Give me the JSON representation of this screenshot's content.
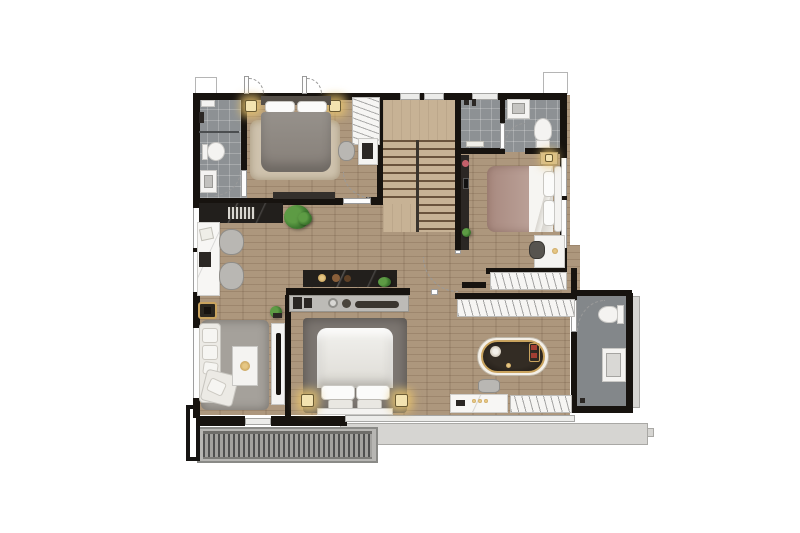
{
  "scene": {
    "type": "architectural-floor-plan",
    "view": "top-down-render",
    "floor": "upper-floor-with-staircase",
    "rooms": [
      {
        "id": "bathroom-top-left",
        "features": [
          "shower",
          "toilet",
          "washbasin"
        ]
      },
      {
        "id": "bedroom-top-left",
        "features": [
          "double-bed",
          "area-rug",
          "bedside-lamps",
          "wardrobe",
          "desk",
          "office-chair",
          "balcony-doors",
          "bench-runner"
        ]
      },
      {
        "id": "staircase",
        "features": [
          "u-shaped-stairs",
          "upper-landing",
          "railing"
        ]
      },
      {
        "id": "bathroom-top-right",
        "features": [
          "shower-fittings",
          "washbasin",
          "toilet",
          "door-swing"
        ]
      },
      {
        "id": "bedroom-right",
        "features": [
          "double-bed",
          "tv-console",
          "nightstand-lamp",
          "desk",
          "chair",
          "windows"
        ]
      },
      {
        "id": "walk-in-closet",
        "features": [
          "upper-wardrobe-run",
          "lower-wardrobe-run"
        ]
      },
      {
        "id": "master-bathroom",
        "features": [
          "toilet",
          "shower-enclosure",
          "door-swing"
        ]
      },
      {
        "id": "master-suite",
        "features": [
          "double-bed",
          "dark-rug",
          "nightstand-lamps",
          "freestanding-bathtub",
          "marble-vanity",
          "stool",
          "wardrobe",
          "pantry-counter",
          "island-counter",
          "entry-door-swing"
        ]
      },
      {
        "id": "study-lounge",
        "features": [
          "marble-sideboard",
          "plants",
          "writing-desk",
          "office-chairs",
          "gold-side-table",
          "sofa",
          "coffee-table",
          "tv-console",
          "rug"
        ]
      },
      {
        "id": "balcony",
        "features": [
          "slatted-deck",
          "planter-outline",
          "concrete-ledge",
          "balcony-door"
        ]
      }
    ]
  },
  "palette": {
    "wall": "#17130f",
    "wood": "#ad977d",
    "stairs": "#c7b295",
    "tile": "#8d9194",
    "tile_dark": "#83878a",
    "white_furn": "#f4f3f1",
    "marble_dark": "#221f1c",
    "gold": "#c9a35e",
    "rug_beige": "#cfc3ae",
    "rug_gray": "#a5a19b",
    "rug_dark": "#7d7772",
    "sofa": "#eceae5",
    "bed_gray": "#8b8680",
    "bed_mauve": "#b5988f",
    "plant_green": "#4d8a3b",
    "glow": "#e9c46e",
    "background": "#ffffff"
  }
}
